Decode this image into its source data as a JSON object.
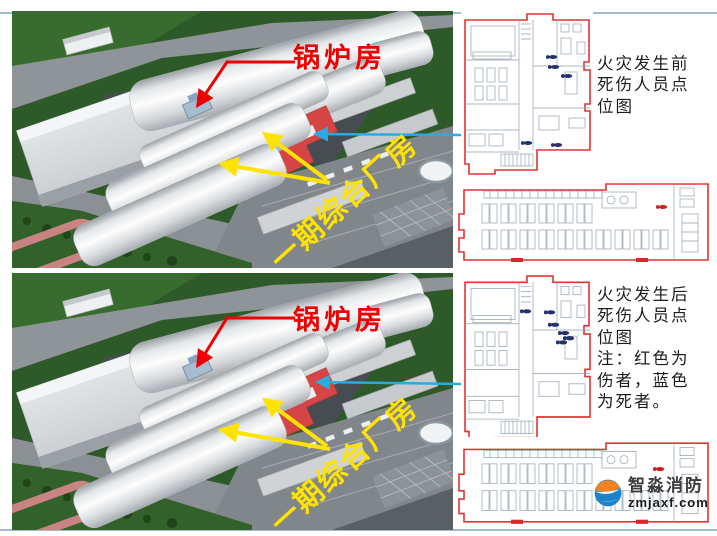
{
  "panels": {
    "before": {
      "boiler_label": "锅炉房",
      "factory_label": "一期综合厂房",
      "caption_lines": [
        "火灾发生前",
        "死伤人员点",
        "位图"
      ]
    },
    "after": {
      "boiler_label": "锅炉房",
      "factory_label": "一期综合厂房",
      "caption_lines": [
        "火灾发生后",
        "死伤人员点",
        "位图"
      ],
      "note_lines": [
        "注：红色为",
        "伤者，蓝色",
        "为死者。"
      ]
    }
  },
  "logo": {
    "name": "智淼消防",
    "url": "zmjaxf.com"
  },
  "colors": {
    "label_red": "#ee0000",
    "label_yellow": "#ffe300",
    "plan_outline_red": "#e23333",
    "connector_blue": "#29abe2",
    "casualty_dead_blue": "#26326e",
    "casualty_injured_red": "#cc1f1f",
    "highlight_roof_red": "#d64545",
    "grass_green": "#2e5a2a"
  }
}
